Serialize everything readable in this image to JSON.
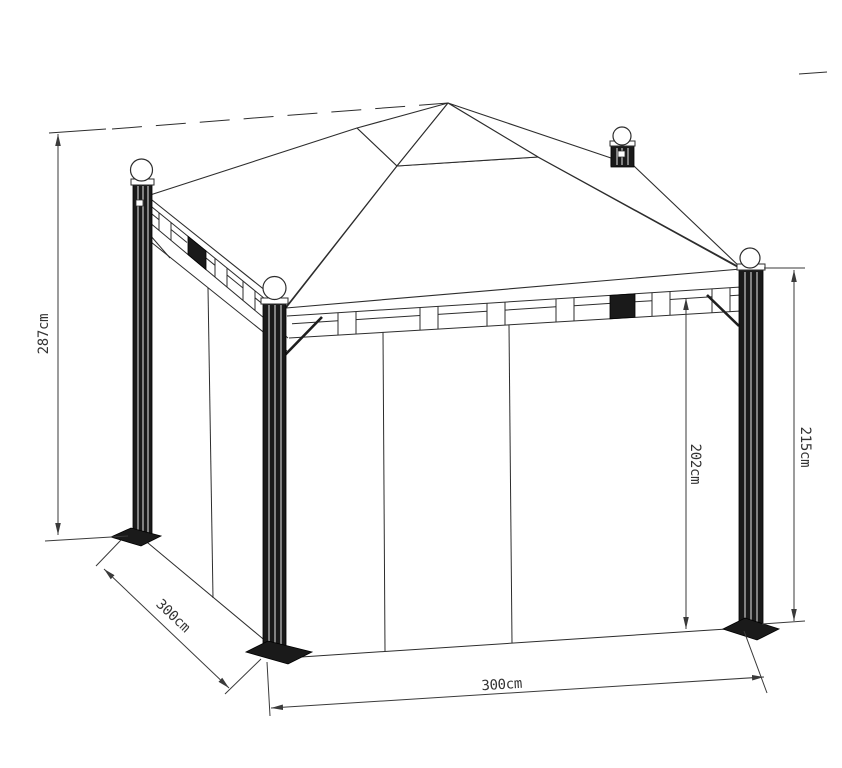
{
  "drawing": {
    "subject": "gazebo technical dimension drawing",
    "style": "black line art on white",
    "colors": {
      "line": "#2d2d2d",
      "background": "#ffffff",
      "post_fill": "#1a1a1a"
    }
  },
  "labels": {
    "height_total": "287cm",
    "depth_side": "300cm",
    "width_front": "300cm",
    "height_clearance": "202cm",
    "height_post": "215cm"
  }
}
